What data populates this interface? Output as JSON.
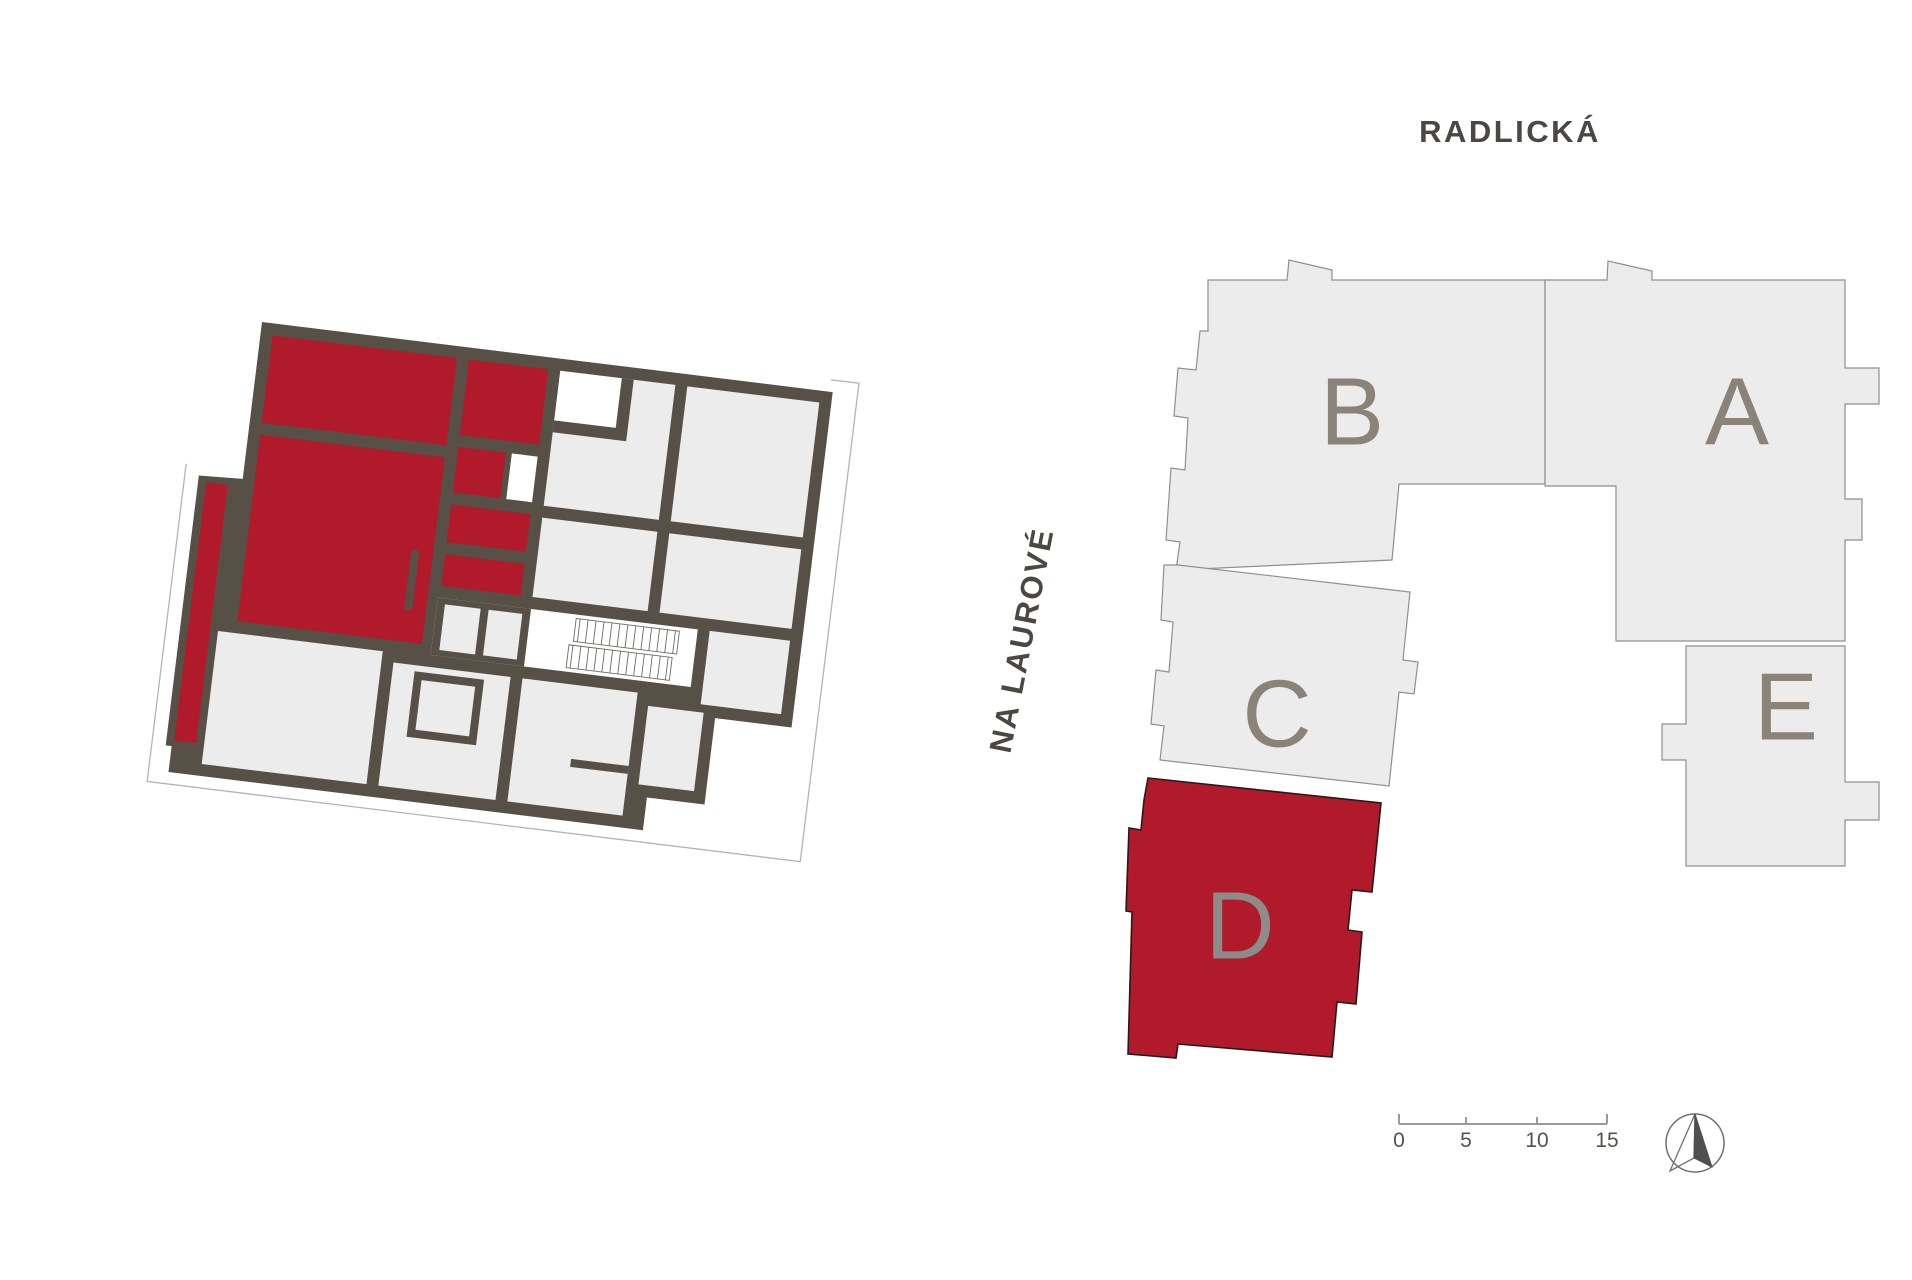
{
  "streets": {
    "top_label": "RADLICKÁ",
    "left_label": "NA LAUROVÉ"
  },
  "site_plan": {
    "buildings": [
      {
        "label": "A",
        "highlighted": false
      },
      {
        "label": "B",
        "highlighted": false
      },
      {
        "label": "C",
        "highlighted": false
      },
      {
        "label": "D",
        "highlighted": true
      },
      {
        "label": "E",
        "highlighted": false
      }
    ],
    "highlighted_building": "D",
    "scale_bar": {
      "ticks": [
        "0",
        "5",
        "10",
        "15"
      ]
    },
    "north_arrow_icon": "north-arrow-compass"
  },
  "floor_plan": {
    "highlighted_unit": "D",
    "highlight_color": "#B01A2B"
  },
  "colors": {
    "highlight_red": "#B01A2B",
    "wall_dark": "#575046",
    "room_gray": "#ECECEC",
    "site_building_gray": "#ECECEC",
    "site_outline_gray": "#8F8F8F",
    "building_label_gray": "#8B8278",
    "street_text": "#4B4742",
    "scale_text": "#56524C"
  }
}
